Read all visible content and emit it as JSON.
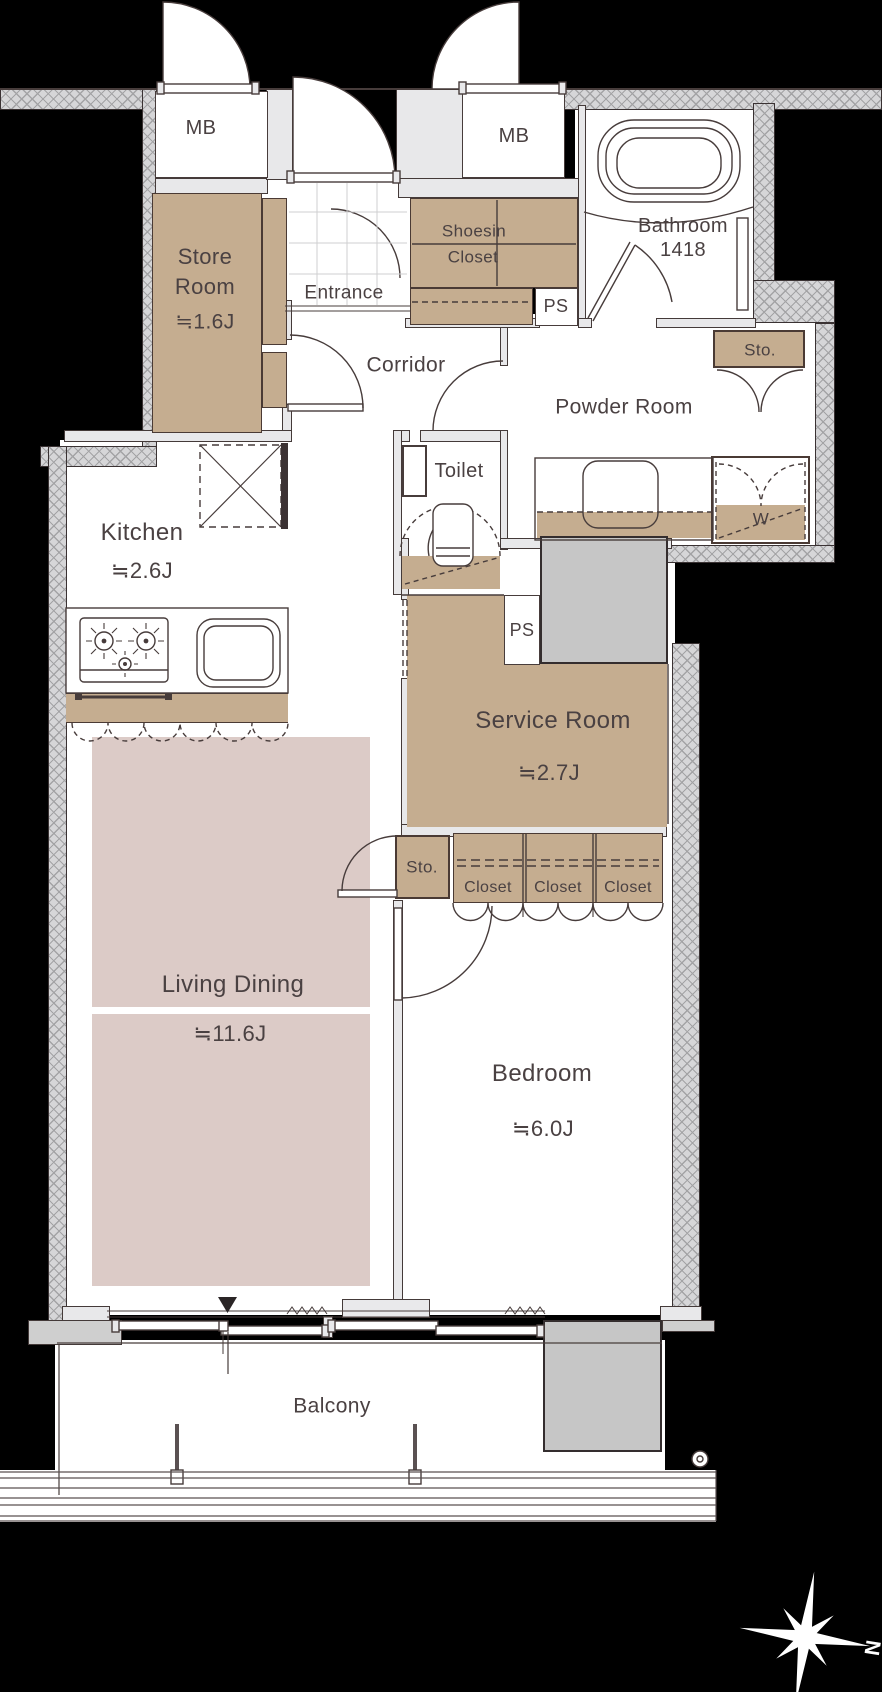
{
  "floor_plan": {
    "rooms": {
      "store_room": {
        "name_line1": "Store",
        "name_line2": "Room",
        "size": "≒1.6J"
      },
      "entrance": {
        "name": "Entrance"
      },
      "shoesin_closet": {
        "name_line1": "Shoesin",
        "name_line2": "Closet"
      },
      "corridor": {
        "name": "Corridor"
      },
      "bathroom": {
        "name": "Bathroom",
        "size": "1418"
      },
      "powder_room": {
        "name": "Powder Room"
      },
      "toilet": {
        "name": "Toilet"
      },
      "kitchen": {
        "name": "Kitchen",
        "size": "≒2.6J"
      },
      "service_room": {
        "name": "Service Room",
        "size": "≒2.7J"
      },
      "living_dining": {
        "name": "Living Dining",
        "size": "≒11.6J"
      },
      "bedroom": {
        "name": "Bedroom",
        "size": "≒6.0J"
      },
      "balcony": {
        "name": "Balcony"
      }
    },
    "fixtures": {
      "meter_box_1": "MB",
      "meter_box_2": "MB",
      "pipe_space_upper": "PS",
      "pipe_space_lower": "PS",
      "storage_powder": "Sto.",
      "storage_hall": "Sto.",
      "washing_machine": "W",
      "closets": [
        "Closet",
        "Closet",
        "Closet"
      ]
    },
    "compass": {
      "north_label": "N"
    },
    "colors": {
      "background": "#000000",
      "wall_hatch_fill": "#d6d6d8",
      "wall_line": "#473c3b",
      "closet_tan": "#c5ad90",
      "rug_pink": "#dccbc7",
      "shaft_gray": "#c6c6c6",
      "text": "#4a4142",
      "floor_white": "#ffffff"
    }
  }
}
